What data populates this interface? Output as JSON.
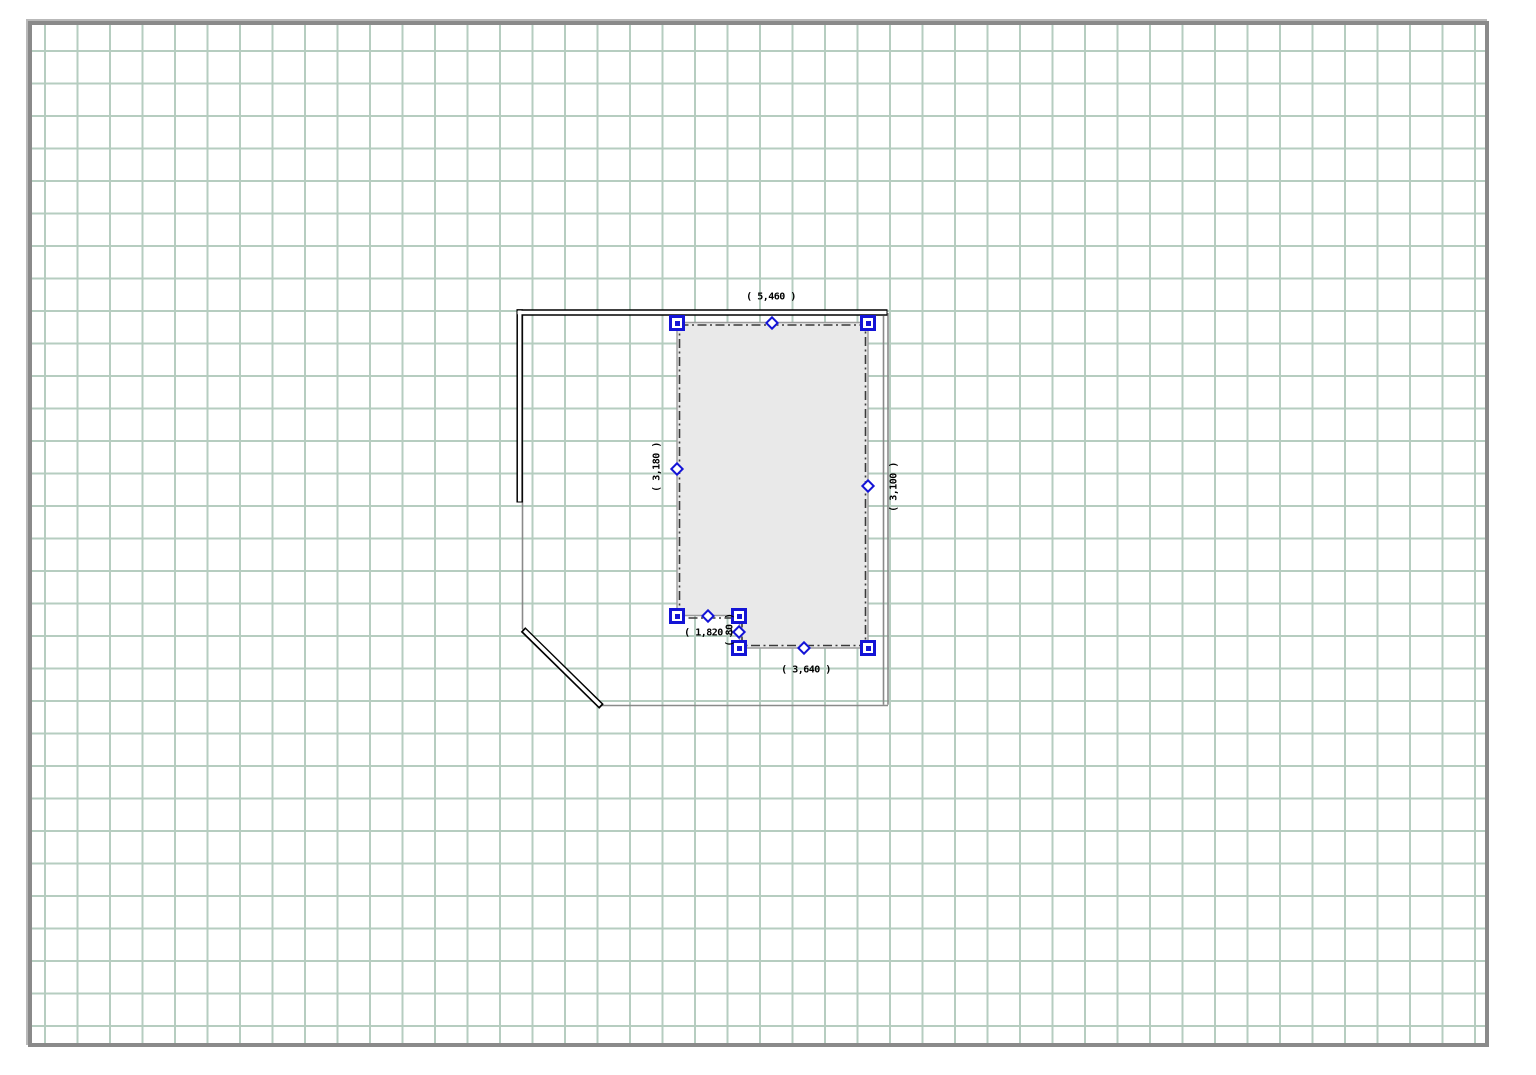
{
  "editor": {
    "description": "floor plan drawing canvas",
    "selected_object": "floor-area"
  },
  "dimensions": {
    "top": "( 5,460 )",
    "left": "( 3,180 )",
    "right": "( 3,100 )",
    "bottom": "( 3,640 )",
    "notch_bottom": "( 1,820 )",
    "notch_step": "( 80 )"
  },
  "colors": {
    "grid_line": "#b6cdc0",
    "canvas_border": "#8a8a8a",
    "wall": "#000000",
    "room_outline": "#8a8a8a",
    "selection_handle": "#1414d6",
    "selection_fill": "#e9e9e9",
    "selection_marquee": "#3a3a3a",
    "dimension_text": "#000000"
  }
}
